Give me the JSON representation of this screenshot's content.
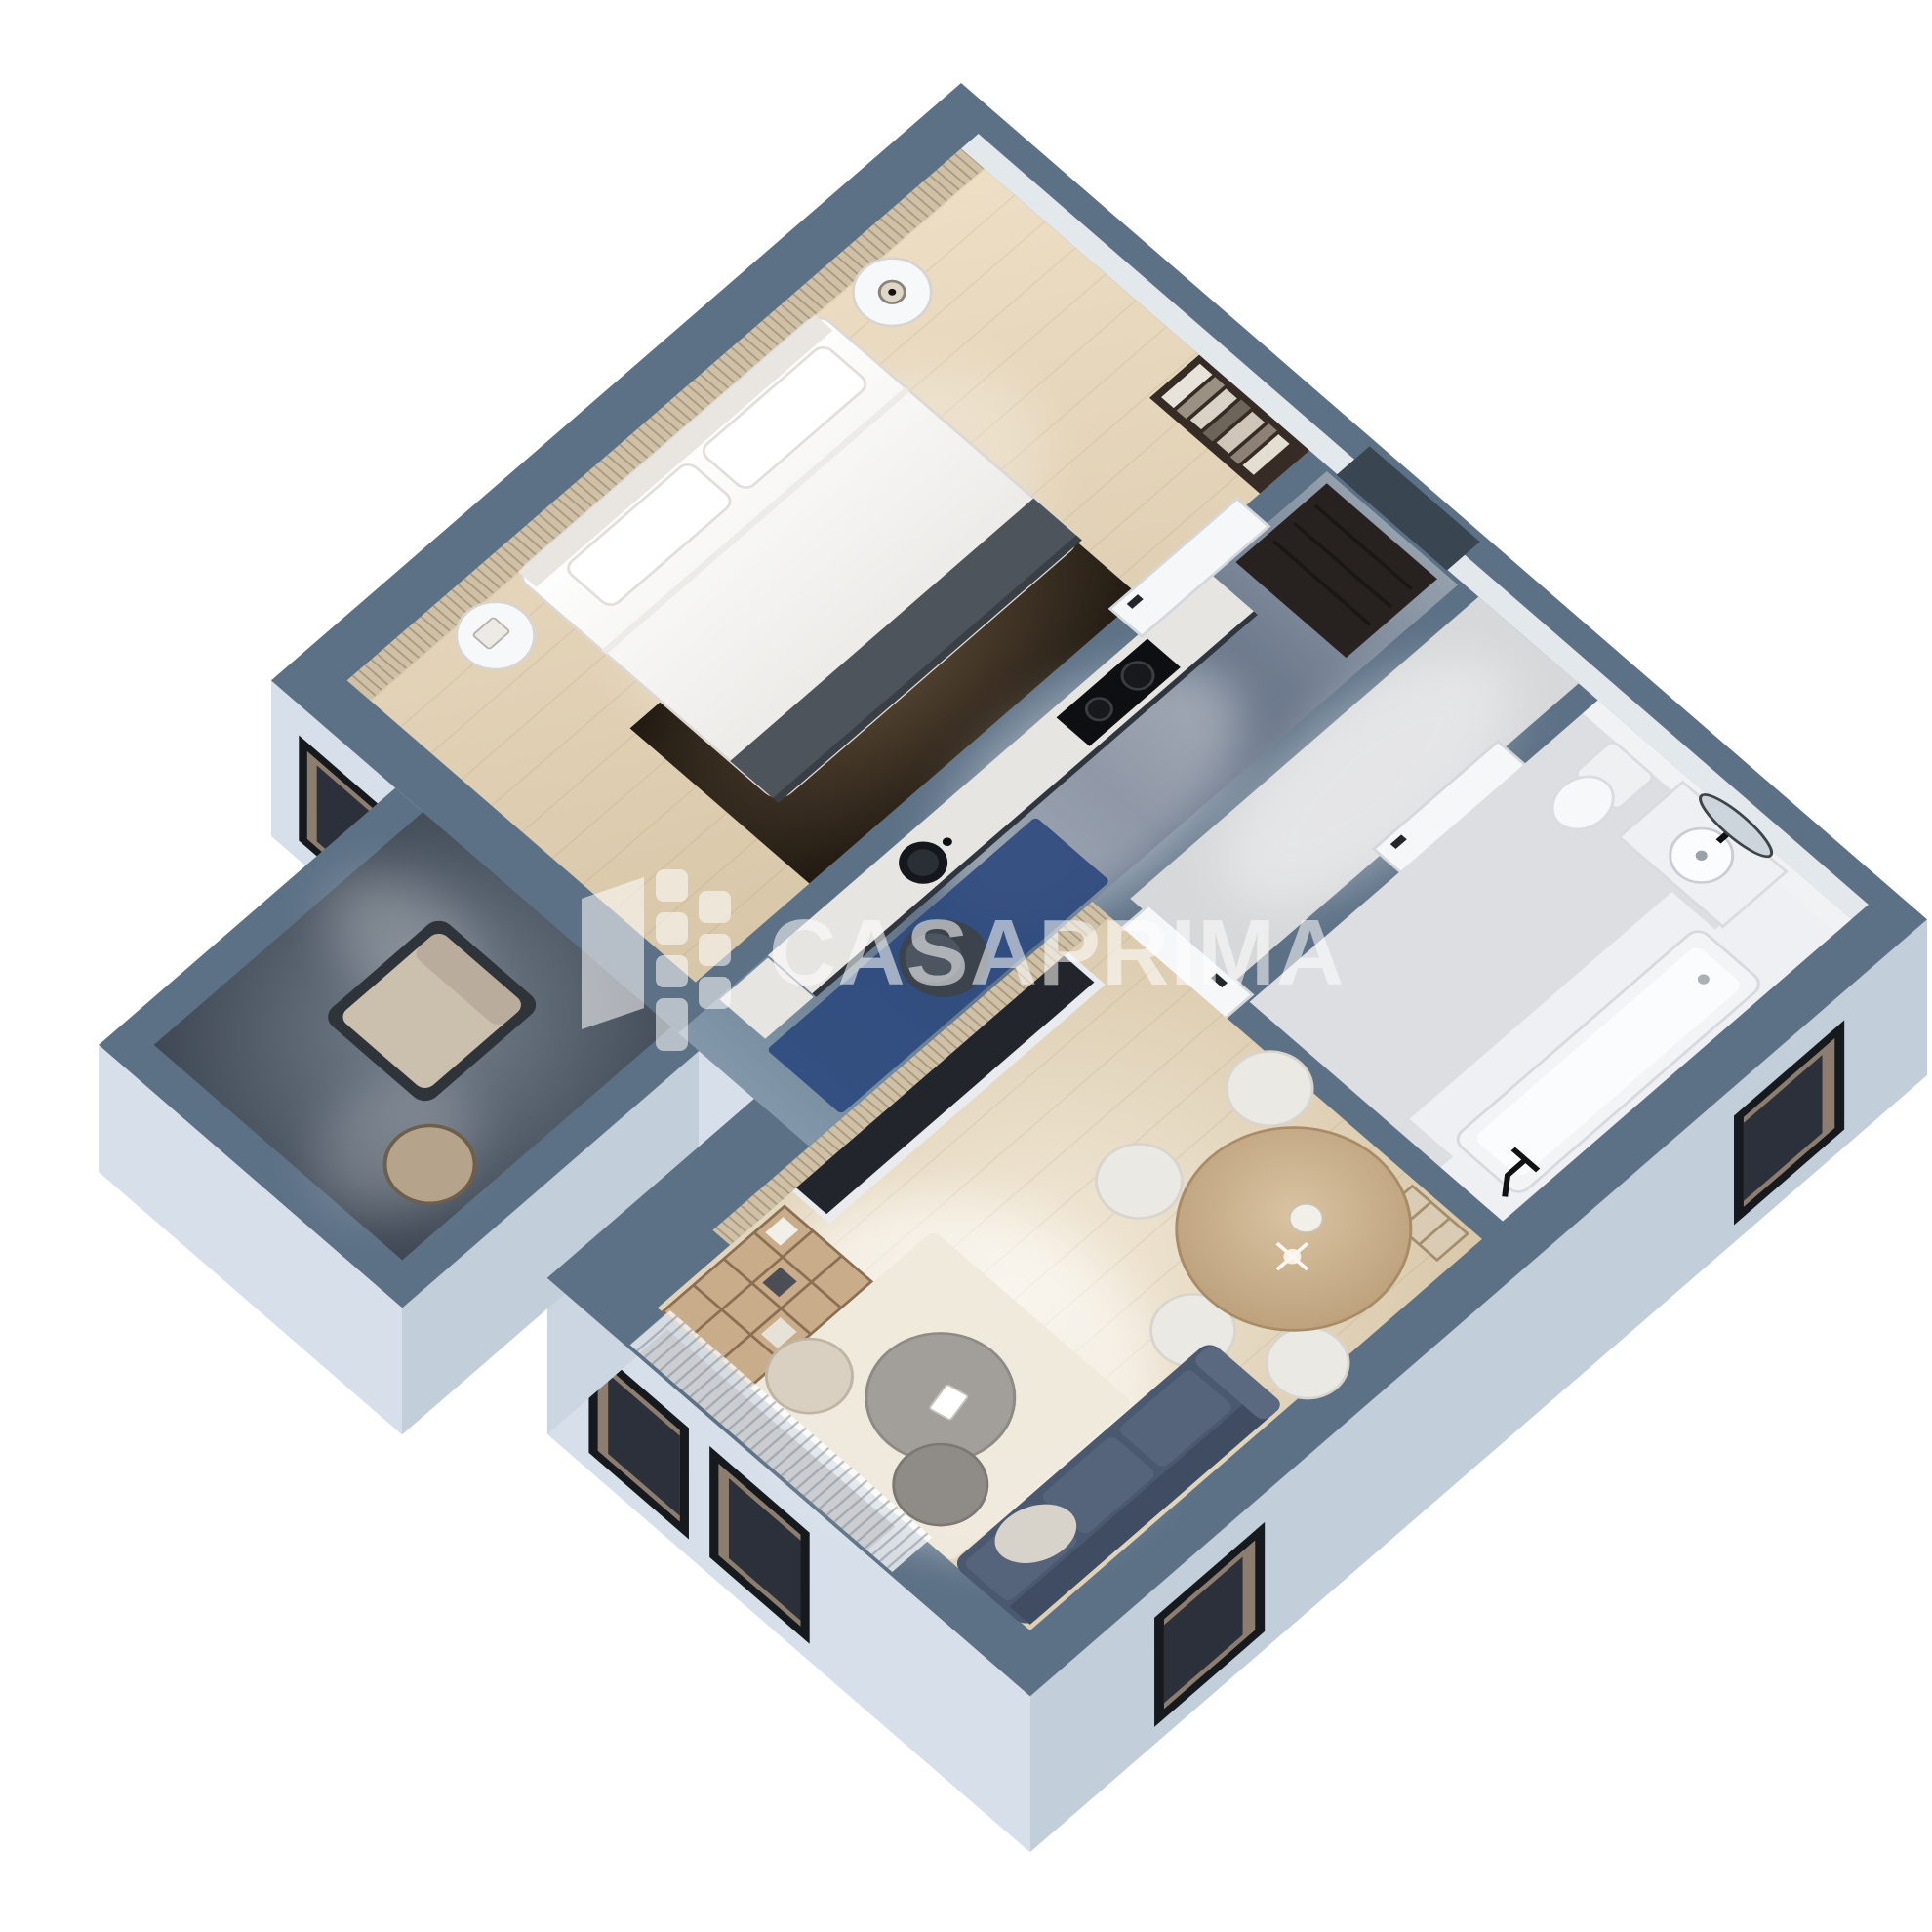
{
  "scene": {
    "type": "isometric-3d-floor-plan-render",
    "background": "#ffffff"
  },
  "watermark": {
    "text": "CASAPRIMA",
    "logo": "casaprima-building-logo",
    "color": "rgba(255,255,255,0.55)"
  },
  "palette": {
    "background": "#ffffff",
    "slate": "#5d7186",
    "facade-sw": "#d7e0ea",
    "facade-se": "#c3cedb",
    "facade-return": "#ccd6e2",
    "hall-floor": "#d7d8da",
    "bath-floor": "#dcdee1",
    "marble": "#eef0f3",
    "slat-wood": "#cfc0a6",
    "wardrobe": "#362c25",
    "doormat": "#272220",
    "fixture-white": "#f7f8fa",
    "bed-throw": "#4e545c",
    "counter-marble": "#e7e5e1",
    "cooktop": "#0d0f12",
    "sink": "#14171c",
    "blue-rug": "#2e4a7e",
    "desk-chair": "#3c434d",
    "tv-console": "#22262c",
    "shelf-wood": "#c9ad8a",
    "table-wood": "#c3a47f",
    "chair-white": "#ebe9e4",
    "sofa": "#4a5870",
    "sofa-back": "#3f4c62",
    "sofa-seat": "#55647b",
    "coffee-table": "#a29f9a",
    "rug-cream": "#efe9dc",
    "pouf": "#d9d0c2",
    "glass": "#353b46",
    "window-frame": "#16191e",
    "window-reveal": "#8d7d6e",
    "window-glass": "#2b303a",
    "watermark": "rgba(255,255,255,0.55)"
  },
  "apartment": {
    "rooms": [
      {
        "name": "bedroom",
        "furniture": [
          "slat-accent-wall",
          "wardrobe",
          "double-bed",
          "pillows",
          "throw-blanket",
          "nightstand-left",
          "nightstand-right",
          "table-lamp",
          "dark-area-rug"
        ]
      },
      {
        "name": "entry",
        "furniture": [
          "doormat"
        ]
      },
      {
        "name": "hallway",
        "furniture": [
          "bedroom-door",
          "bathroom-door",
          "living-room-door"
        ]
      },
      {
        "name": "bathroom",
        "furniture": [
          "toilet",
          "vanity-sink",
          "mirror",
          "bathtub",
          "shower-fixture",
          "marble-floor"
        ]
      },
      {
        "name": "kitchen",
        "furniture": [
          "cabinet-run",
          "cooktop",
          "sink",
          "blue-runner-rug",
          "desk-chair",
          "balcony-door"
        ]
      },
      {
        "name": "living-dining",
        "furniture": [
          "tv-slat-wall",
          "tv-console",
          "bookshelf",
          "dining-table",
          "dining-chairs",
          "pendant-light",
          "side-shelf",
          "sofa",
          "coffee-table-set",
          "pouf",
          "cream-rug",
          "sheer-curtains"
        ]
      },
      {
        "name": "balcony",
        "furniture": [
          "lounge-chair",
          "side-table",
          "stone-floor"
        ]
      }
    ],
    "windows": {
      "se-facade": 2,
      "sw-facade-living": 2,
      "sw-facade-bedroom": 1
    }
  }
}
